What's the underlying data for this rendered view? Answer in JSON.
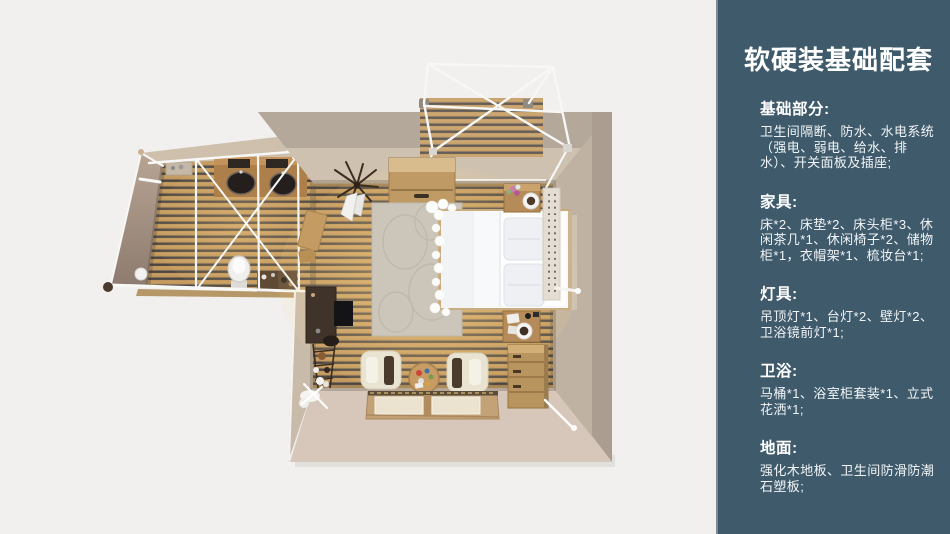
{
  "sidebar": {
    "title": "软硬装基础配套",
    "accent_color": "#3e5a6b",
    "sections": [
      {
        "heading": "基础部分:",
        "body": "卫生间隔断、防水、水电系统（强电、弱电、给水、排水）、开关面板及插座;"
      },
      {
        "heading": "家具:",
        "body": "床*2、床垫*2、床头柜*3、休闲茶几*1、休闲椅子*2、储物柜*1，衣帽架*1、梳妆台*1;"
      },
      {
        "heading": "灯具:",
        "body": "吊顶灯*1、台灯*2、壁灯*2、卫浴镜前灯*1;"
      },
      {
        "heading": "卫浴:",
        "body": "马桶*1、浴室柜套装*1、立式花洒*1;"
      },
      {
        "heading": "地面:",
        "body": "强化木地板、卫生间防滑防潮石塑板;"
      }
    ]
  },
  "floor_plan": {
    "colors": {
      "background": "#f1f0ee",
      "floor_wood": "#c0965c",
      "wall_beige": "#d0c2b1",
      "frame_white": "#f7f7f5"
    },
    "elements": [
      "bathroom-pod",
      "double-sink-vanity",
      "toilet",
      "shower-frame",
      "bedroom",
      "double-bed",
      "pillows",
      "rug",
      "desk",
      "shelf-rack",
      "armchair-left",
      "armchair-right",
      "coffee-table",
      "tatami-platform",
      "dresser",
      "nightstand-top",
      "nightstand-bottom",
      "storage-cabinet",
      "coat-rack",
      "deck",
      "canopy-frame",
      "wall-lamp-left",
      "wall-lamp-right"
    ]
  }
}
